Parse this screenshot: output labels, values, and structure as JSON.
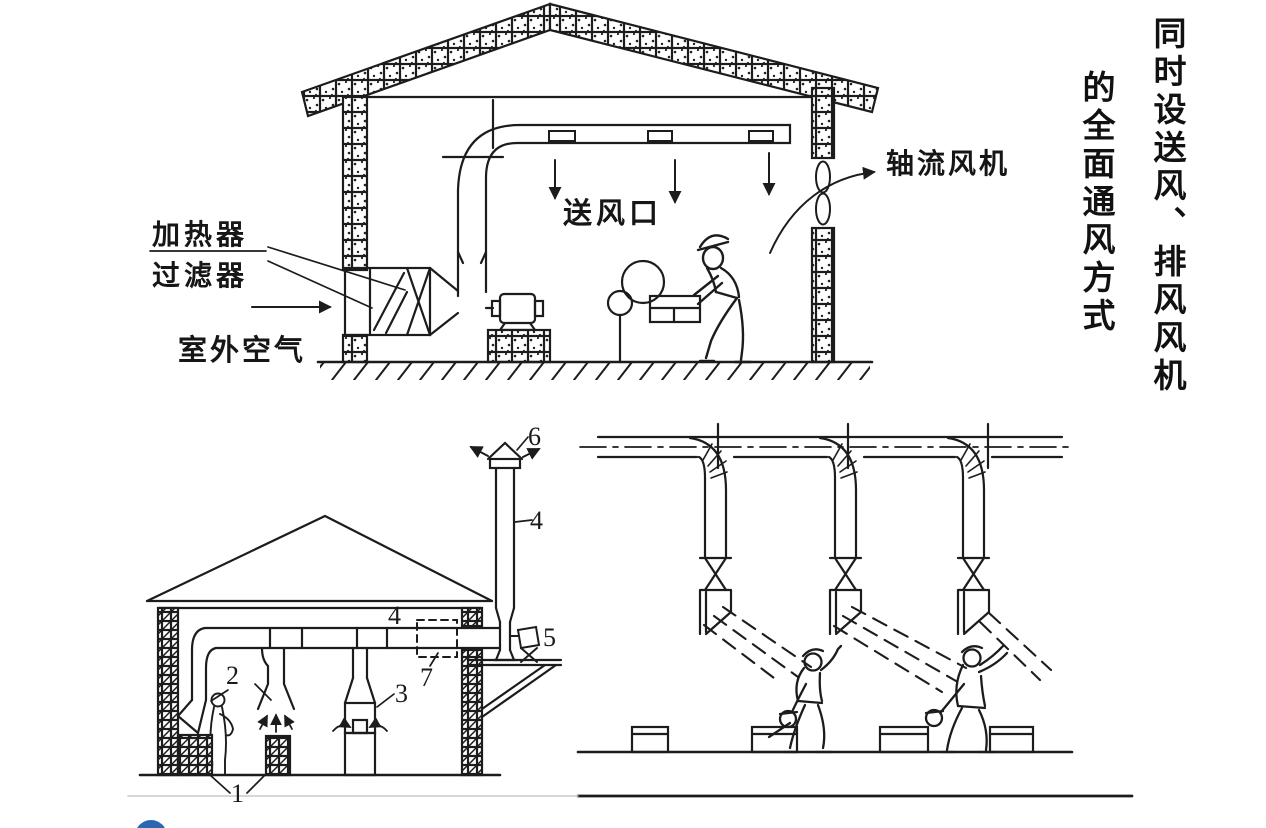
{
  "page": {
    "background": "#ffffff",
    "colors": {
      "ink": "#1c1c1c",
      "logo_blue": "#2a67b2",
      "divider_gray": "#c9c9c9"
    }
  },
  "title": {
    "column_right": "同时设送风、排风风机",
    "column_left": "的全面通风方式"
  },
  "top_diagram": {
    "labels": {
      "heater": "加热器",
      "filter": "过滤器",
      "outdoor_air": "室外空气",
      "supply_outlet": "送风口",
      "axial_fan": "轴流风机"
    }
  },
  "bottom_left_diagram": {
    "callouts": {
      "c1": "1",
      "c2": "2",
      "c3": "3",
      "c4_duct": "4",
      "c4_stack": "4",
      "c5": "5",
      "c6": "6",
      "c7": "7"
    }
  }
}
